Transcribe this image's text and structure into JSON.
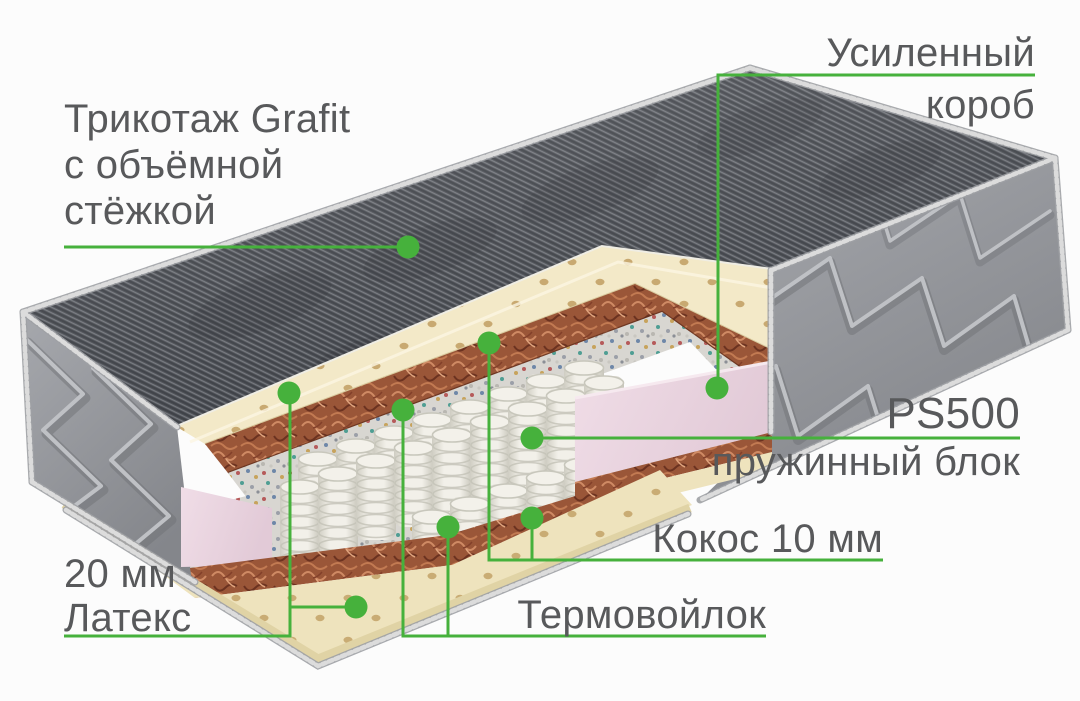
{
  "colors": {
    "background": "#fcfcfc",
    "accent_green": "#46b13c",
    "label_text": "#58595b",
    "knit_cover_dark": "#4c4f55",
    "quilted_side_gray": "#94969b",
    "latex_cream": "#f3e9c8",
    "coir_brown": "#9a5638",
    "felt_gray": "#d8d6d1",
    "foam_box_pink": "#e9d3df",
    "spring_white": "#f0eee7"
  },
  "callouts": {
    "knit_cover": {
      "line1": "Трикотаж Grafit",
      "line2": "с объёмной",
      "line3": "стёжкой"
    },
    "reinforced_box": {
      "line1": "Усиленный",
      "line2": "короб"
    },
    "spring_block": {
      "title": "PS500",
      "subtitle": "пружинный блок"
    },
    "coconut": {
      "label": "Кокос 10 мм"
    },
    "thermofelt": {
      "label": "Термовойлок"
    },
    "latex": {
      "line1": "20 мм",
      "line2": "Латекс"
    }
  }
}
